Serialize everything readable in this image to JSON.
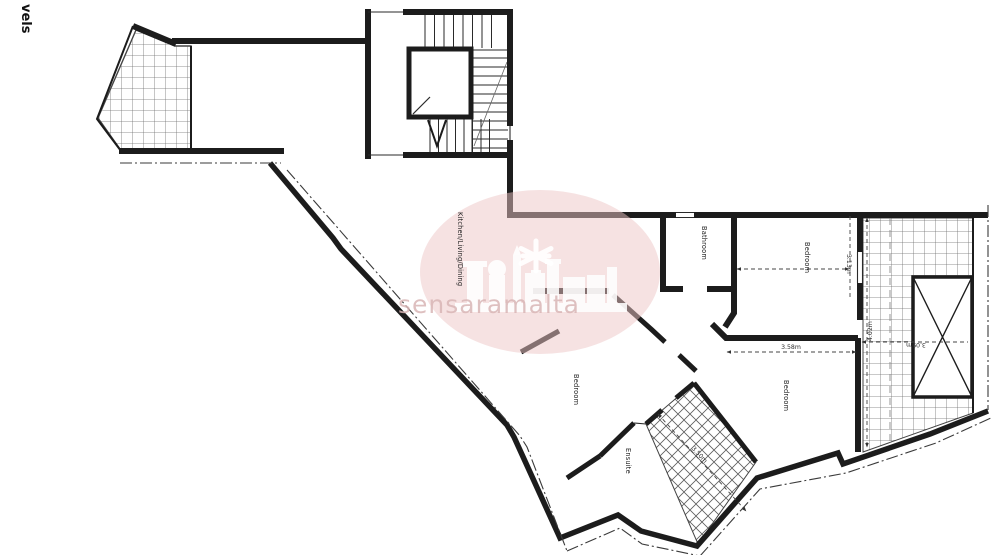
{
  "page": {
    "side_label": "vels"
  },
  "watermark": {
    "text": "sensaramalta",
    "circle_color": "#eec5c5"
  },
  "plan": {
    "rooms": [
      {
        "id": "kitchen-living-dining",
        "label": "Kitchen/Living/Dining"
      },
      {
        "id": "bathroom",
        "label": "Bathroom"
      },
      {
        "id": "bedroom-top-right",
        "label": "Bedroom"
      },
      {
        "id": "bedroom-middle",
        "label": "Bedroom"
      },
      {
        "id": "bedroom-bottom-right",
        "label": "Bedroom"
      },
      {
        "id": "ensuite",
        "label": "Ensuite"
      }
    ],
    "dimensions": [
      {
        "id": "bedroom-top-width",
        "label": "3.13m"
      },
      {
        "id": "bedroom-bottom-width",
        "label": "3.58m"
      },
      {
        "id": "terrace-height",
        "label": "4.02m"
      },
      {
        "id": "terrace-width",
        "label": "3.09m"
      },
      {
        "id": "terrace-diagonal",
        "label": "3.50m"
      }
    ],
    "colors": {
      "wall": "#1c1c1c",
      "hatch": "#777777",
      "dimension": "#333333"
    }
  }
}
